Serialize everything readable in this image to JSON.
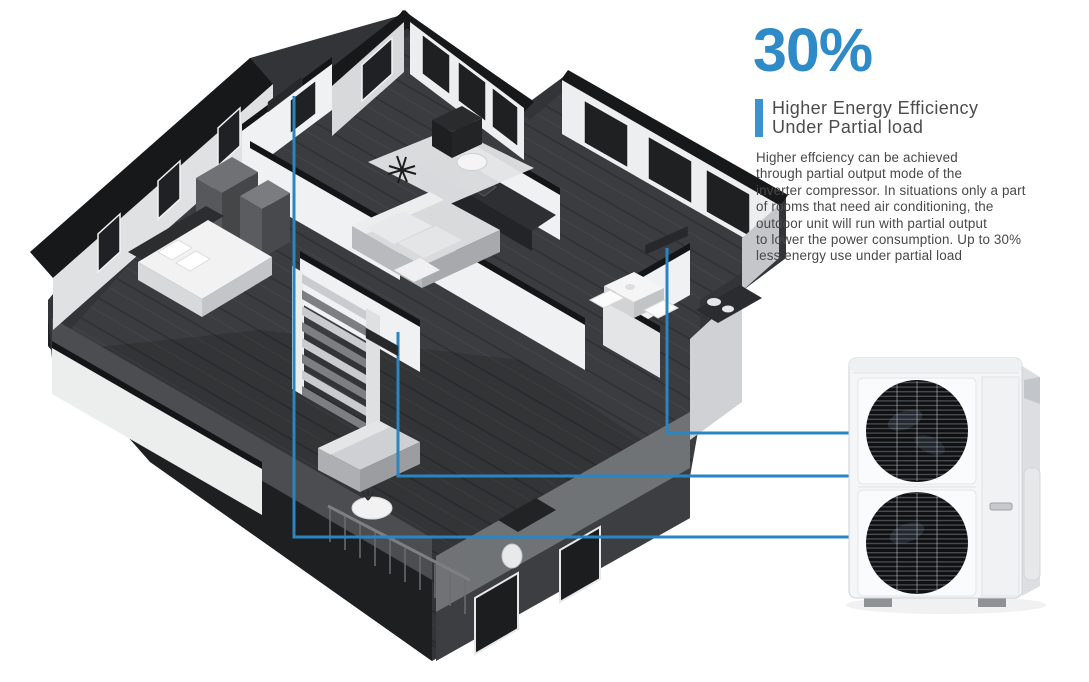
{
  "stat": {
    "value": "30%"
  },
  "heading": {
    "line1": "Higher Energy Efficiency",
    "line2": "Under Partial load"
  },
  "body_text": "Higher effciency can be achieved\nthrough partial output mode of the\ninverter compressor. In situations only a part\nof rooms that need air conditioning, the\noutdoor unit will run with partial output\nto lower the power consumption. Up to 30%\nless energy use under partial load",
  "colors": {
    "accent_blue": "#2e8bc7",
    "pipe_blue": "#2a85c3",
    "heading_gray": "#4c4c4e",
    "body_gray": "#48484a"
  },
  "diagram": {
    "illustration": "isometric-cutaway-house",
    "indoor_unit_count": 3,
    "outdoor_unit": "dual-fan-outdoor-unit",
    "pipe_count": 3
  }
}
